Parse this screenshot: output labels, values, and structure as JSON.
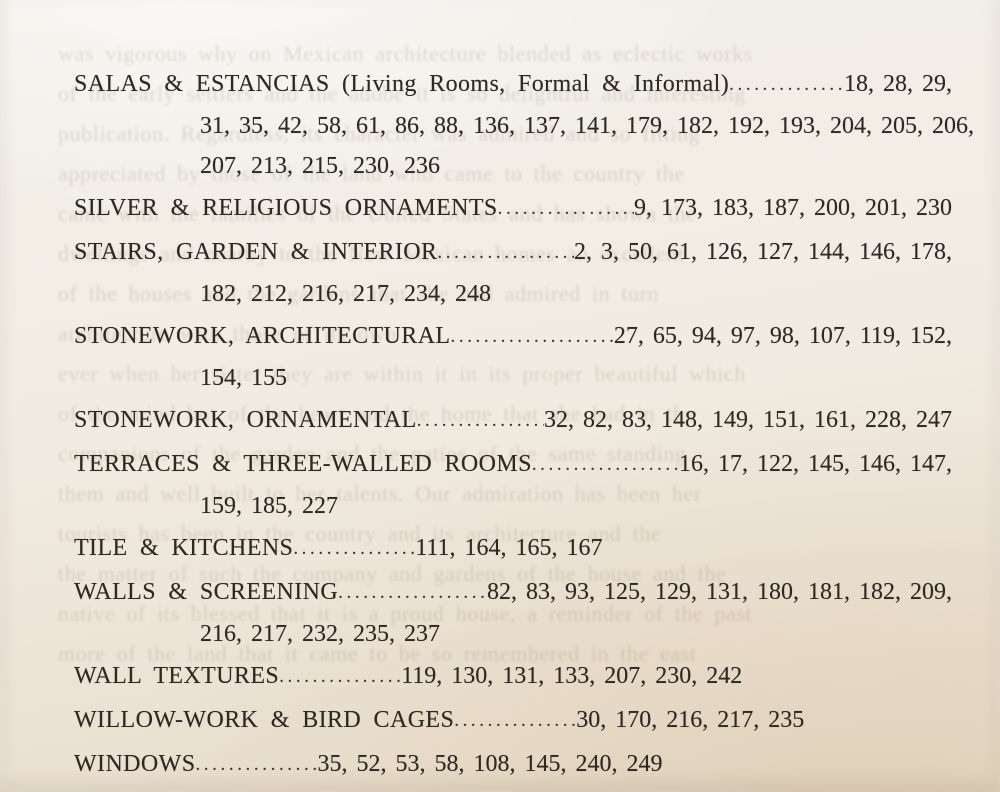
{
  "page": {
    "kind": "book-index-page",
    "paper_top_color": "#f3f0ea",
    "paper_bottom_color": "#e7dcc9",
    "ink_color": "#2e2922"
  },
  "index": {
    "entries": [
      {
        "label": "SALAS & ESTANCIAS (Living Rooms, Formal & Informal)",
        "fill": true,
        "pages_first": "18, 28, 29,",
        "continuations": [
          "31, 35, 42, 58, 61, 86, 88, 136, 137, 141, 179, 182, 192, 193, 204, 205, 206,",
          "207, 213, 215, 230, 236"
        ]
      },
      {
        "label": "SILVER & RELIGIOUS ORNAMENTS",
        "fill": true,
        "pages_first": "9, 173, 183, 187, 200, 201, 230",
        "continuations": []
      },
      {
        "label": "STAIRS, GARDEN & INTERIOR",
        "fill": true,
        "pages_first": "2, 3, 50, 61, 126, 127, 144, 146, 178,",
        "continuations": [
          "182, 212, 216, 217, 234, 248"
        ]
      },
      {
        "label": "STONEWORK, ARCHITECTURAL",
        "fill": true,
        "pages_first": "27, 65, 94, 97, 98, 107, 119, 152,",
        "continuations": [
          "154, 155"
        ]
      },
      {
        "label": "STONEWORK, ORNAMENTAL",
        "fill": true,
        "pages_first": "32, 82, 83, 148, 149, 151, 161, 228, 247",
        "continuations": []
      },
      {
        "label": "TERRACES & THREE-WALLED ROOMS",
        "fill": true,
        "pages_first": "16, 17, 122, 145, 146, 147,",
        "continuations": [
          "159, 185, 227"
        ]
      },
      {
        "label": "TILE & KITCHENS",
        "fill": false,
        "pages_first": "111, 164, 165, 167",
        "continuations": []
      },
      {
        "label": "WALLS & SCREENING",
        "fill": true,
        "pages_first": "82, 83, 93, 125, 129, 131, 180, 181, 182, 209,",
        "continuations": [
          "216, 217, 232, 235, 237"
        ]
      },
      {
        "label": "WALL TEXTURES",
        "fill": false,
        "pages_first": "119, 130, 131, 133, 207, 230, 242",
        "continuations": []
      },
      {
        "label": "WILLOW-WORK & BIRD CAGES",
        "fill": false,
        "pages_first": "30, 170, 216, 217, 235",
        "continuations": []
      },
      {
        "label": "WINDOWS",
        "fill": false,
        "pages_first": "35, 52, 53, 58, 108, 145, 240, 249",
        "continuations": []
      }
    ]
  },
  "ghost_text": {
    "note": "faint show-through of printing on reverse side of the leaf",
    "lines": [
      "was vigorous why on Mexican architecture blended as eclectic works",
      "of the early settlers and the adobe it is so delightful and interesting",
      "publication. Regardless, its character was admired and so fitting",
      "appreciated by those of the land who came to the country the",
      "came with the families of the United States and has shown the",
      "dwellings and nearby to the New Mexican homes an excellent",
      "of the houses and the gardens that she had admired in turn",
      "architecture with those of its own",
      "",
      "ever when her sister they are within it in its proper beautiful which",
      "of the mind but of the heart and the home that she had in the",
      "companions of the garden and the patios of the same standing",
      "them and well built to her talents. Our admiration has been her",
      "tourists has been in the country and its architecture and the",
      "the matter of such the company and gardens of the house and the",
      "native of its blessed that it is a proud house, a reminder of the past",
      "more of the land that it came to be so remembered in the east"
    ]
  }
}
